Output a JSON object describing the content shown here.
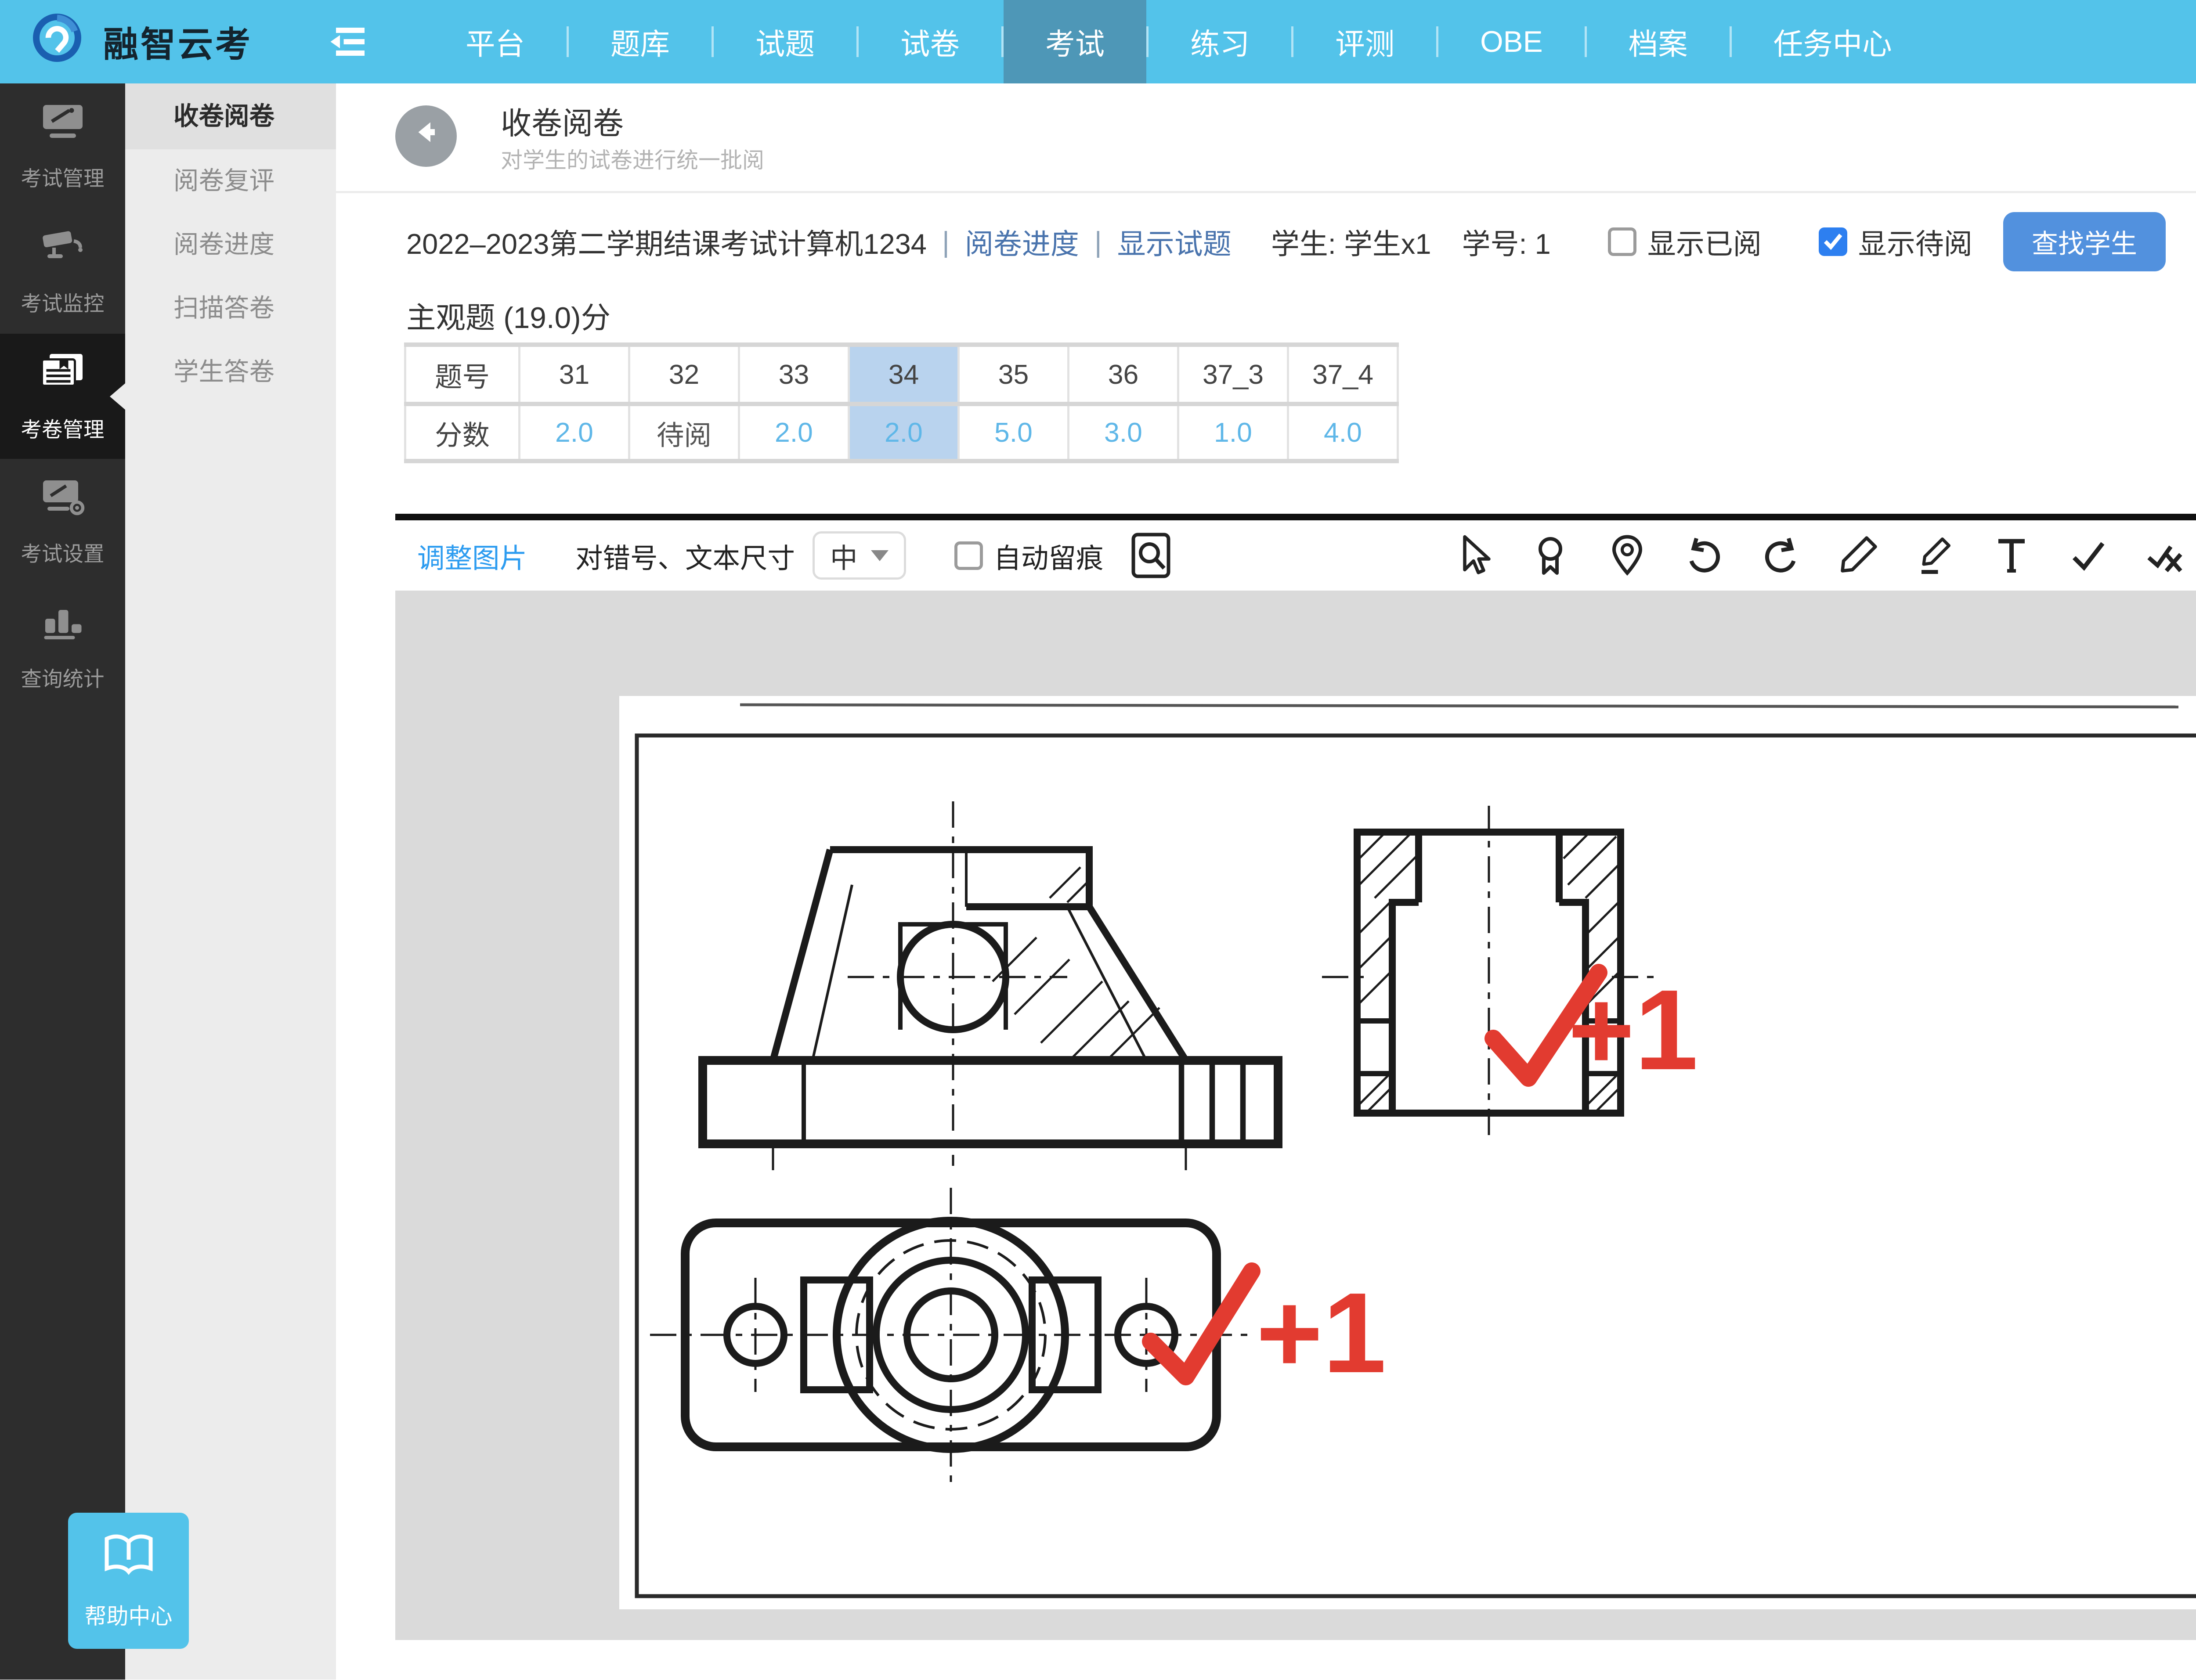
{
  "topbar": {
    "brand": "融智云考",
    "nav": [
      {
        "label": "平台"
      },
      {
        "label": "题库"
      },
      {
        "label": "试题"
      },
      {
        "label": "试卷"
      },
      {
        "label": "考试",
        "active": true
      },
      {
        "label": "练习"
      },
      {
        "label": "评测"
      },
      {
        "label": "OBE"
      },
      {
        "label": "档案"
      },
      {
        "label": "任务中心"
      }
    ]
  },
  "sidebar": {
    "items": [
      {
        "label": "考试管理"
      },
      {
        "label": "考试监控"
      },
      {
        "label": "考卷管理",
        "active": true
      },
      {
        "label": "考试设置"
      },
      {
        "label": "查询统计"
      }
    ],
    "help_label": "帮助中心"
  },
  "submenu": {
    "items": [
      {
        "label": "收卷阅卷",
        "active": true
      },
      {
        "label": "阅卷复评"
      },
      {
        "label": "阅卷进度"
      },
      {
        "label": "扫描答卷"
      },
      {
        "label": "学生答卷"
      }
    ]
  },
  "page": {
    "title": "收卷阅卷",
    "subtitle": "对学生的试卷进行统一批阅"
  },
  "exam_bar": {
    "exam_title": "2022–2023第二学期结课考试计算机1234",
    "pipe": "|",
    "link_progress": "阅卷进度",
    "link_show_question": "显示试题",
    "student": "学生: 学生x1",
    "student_no": "学号: 1",
    "checkbox_reviewed": "显示已阅",
    "checkbox_pending": "显示待阅",
    "btn_find_student": "查找学生",
    "btn_clear_search": "清除搜索",
    "btn_prev": "上一份",
    "btn_next": "下一份",
    "btn_fullscreen": "全屏模式"
  },
  "section": {
    "title": "主观题 (19.0)分"
  },
  "question_table": {
    "row1_header": "题号",
    "row2_header": "分数",
    "columns": [
      {
        "no": "31",
        "score": "2.0"
      },
      {
        "no": "32",
        "score": "待阅",
        "pending": true
      },
      {
        "no": "33",
        "score": "2.0"
      },
      {
        "no": "34",
        "score": "2.0",
        "active": true
      },
      {
        "no": "35",
        "score": "5.0"
      },
      {
        "no": "36",
        "score": "3.0"
      },
      {
        "no": "37_3",
        "score": "1.0"
      },
      {
        "no": "37_4",
        "score": "4.0"
      }
    ]
  },
  "ai_button_label": "AI 一键批阅",
  "viewer_toolbar": {
    "adjust_image": "调整图片",
    "size_label": "对错号、文本尺寸",
    "size_value": "中",
    "auto_trace": "自动留痕"
  },
  "annotations": {
    "plus_one_a": "+1",
    "plus_one_b": "+1"
  },
  "grade_panel": {
    "max_score_label": "满分 2.0 分",
    "btn_full_score": "满分",
    "btn_zero_score": "0分",
    "score_value": "2.0",
    "btn_save": "保存",
    "btn_rereview": "重阅",
    "tab_add": "加法",
    "tab_subtract": "减法",
    "btn_plus1": "+1",
    "btn_plus2": "+2",
    "btn_custom": "自定义"
  },
  "colors": {
    "topbar_blue": "#53c3ea",
    "primary_button_blue": "#5291de",
    "danger_red": "#fb1e1e",
    "link_blue": "#4a74ad",
    "score_red": "#fb2b2b",
    "annotation_red": "#e23b30",
    "tab_active_blue": "#1fa9f2",
    "score_text_blue": "#5fb7e8",
    "highlight_column": "#b9d3ee",
    "ai_button_bg": "#d9e9fd",
    "ai_button_text": "#4a6ce8"
  }
}
